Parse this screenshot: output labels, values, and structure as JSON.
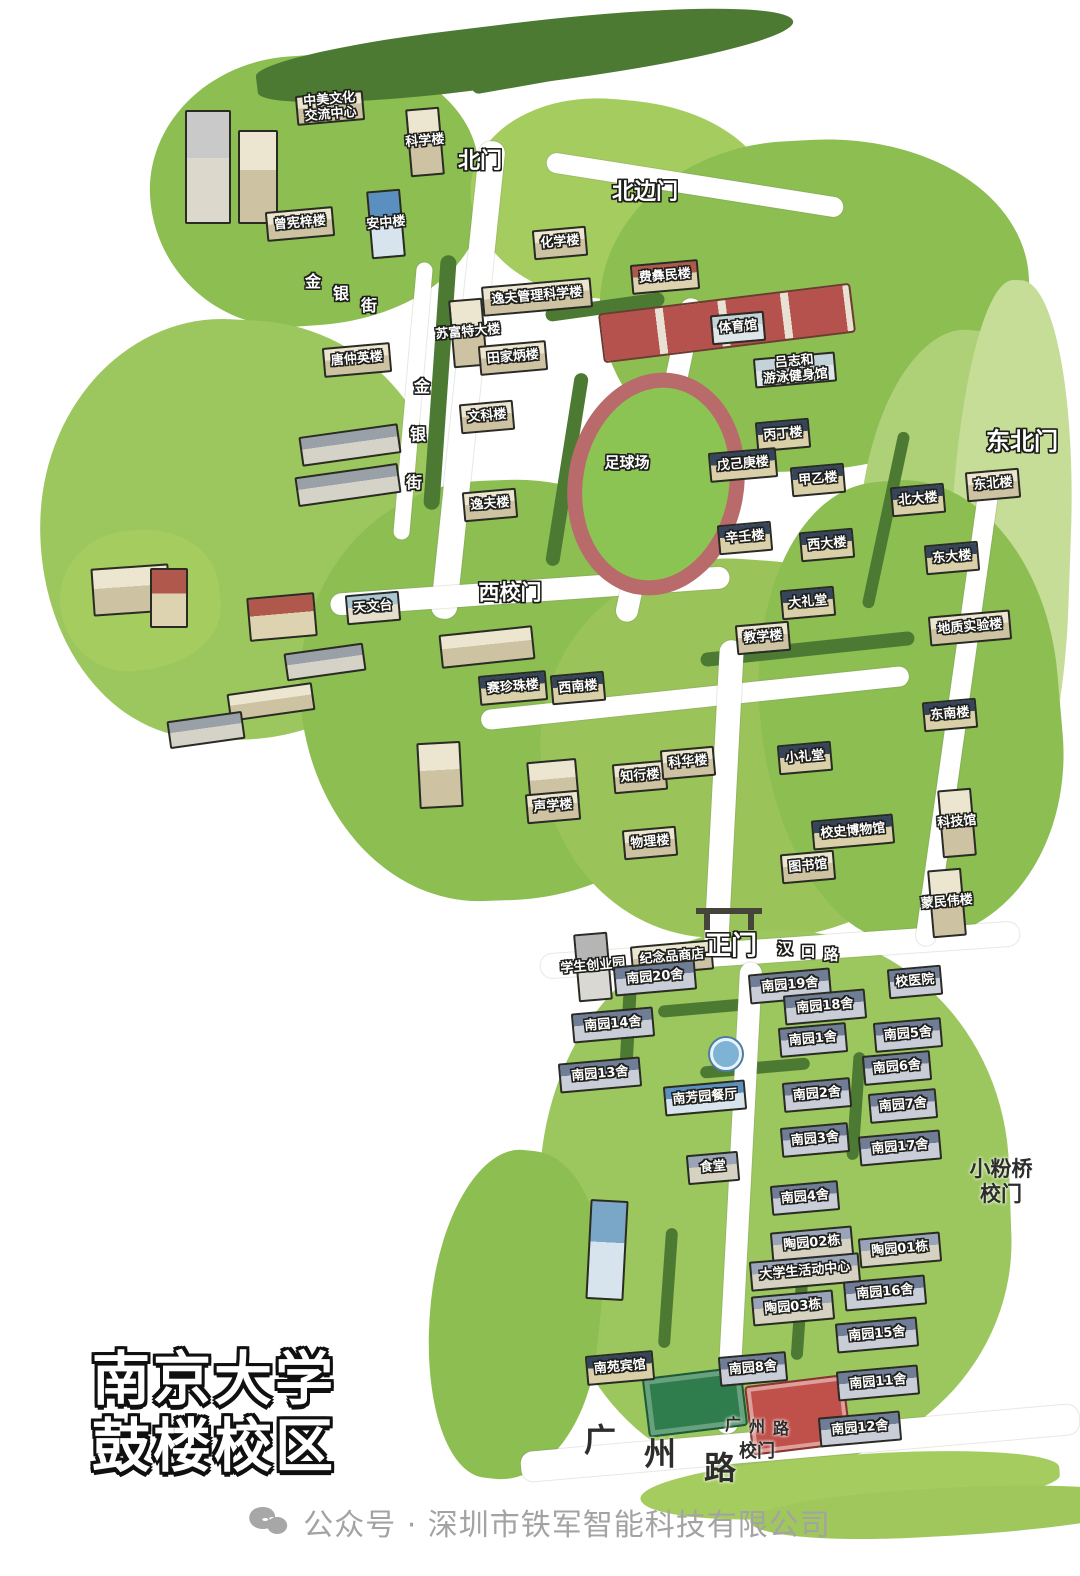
{
  "title": {
    "line1": "南京大学",
    "line2": "鼓楼校区"
  },
  "footer": {
    "icon": "wechat-icon",
    "text": "公众号 · 深圳市铁军智能科技有限公司"
  },
  "palette": {
    "roofs": {
      "trad": [
        "#35465c",
        "#d9cfa8"
      ],
      "tan": [
        "#ece5d0",
        "#cdc3a2"
      ],
      "dorm": [
        "#6f7d96",
        "#c9cdd8"
      ],
      "red": [
        "#b0584c",
        "#ddd3b0"
      ],
      "blue": [
        "#5b8fc0",
        "#d7e4ee"
      ],
      "sport": [
        "#c3d3d9",
        "#dde6e8"
      ],
      "tao": [
        "#9aa4b8",
        "#d6d2c2"
      ],
      "obs": [
        "#a9c6d4",
        "#e4decb"
      ],
      "gray": [
        "#b5b5b5",
        "#dad8d2"
      ]
    },
    "green_light": "#a5cc5f",
    "green_mid": "#8cbe52",
    "green_dark": "#4d7a33",
    "track": "#b96a6a",
    "field": "#8cc454"
  },
  "map": {
    "green_areas": [
      {
        "x": 150,
        "y": 55,
        "w": 330,
        "h": 270,
        "c": "#8cbe52",
        "rot": -4
      },
      {
        "x": 255,
        "y": 22,
        "w": 540,
        "h": 62,
        "c": "#4d7a33",
        "rot": -7,
        "r": "40% 60% 55% 45%"
      },
      {
        "x": 470,
        "y": 100,
        "w": 300,
        "h": 200,
        "c": "#a5cc5f",
        "rot": 5
      },
      {
        "x": 600,
        "y": 140,
        "w": 430,
        "h": 330,
        "c": "#8cbe52",
        "rot": -3
      },
      {
        "x": 860,
        "y": 330,
        "w": 200,
        "h": 380,
        "c": "#aed178",
        "rot": 6
      },
      {
        "x": 950,
        "y": 280,
        "w": 120,
        "h": 560,
        "c": "#c6dd97",
        "rot": 2
      },
      {
        "x": 40,
        "y": 320,
        "w": 400,
        "h": 420,
        "c": "#9cc75e",
        "rot": 3
      },
      {
        "x": 300,
        "y": 480,
        "w": 420,
        "h": 420,
        "c": "#8cbe52",
        "rot": -2
      },
      {
        "x": 540,
        "y": 560,
        "w": 420,
        "h": 380,
        "c": "#9ac359",
        "rot": 4
      },
      {
        "x": 760,
        "y": 480,
        "w": 300,
        "h": 460,
        "c": "#8cbe52",
        "rot": -5
      },
      {
        "x": 540,
        "y": 930,
        "w": 470,
        "h": 540,
        "c": "#9cc75e",
        "rot": -2
      },
      {
        "x": 430,
        "y": 1150,
        "w": 170,
        "h": 330,
        "c": "#8cbe52",
        "rot": 6
      },
      {
        "x": 640,
        "y": 1455,
        "w": 420,
        "h": 60,
        "c": "#a5cc5f",
        "rot": -4
      },
      {
        "x": 60,
        "y": 530,
        "w": 160,
        "h": 140,
        "c": "#a5cc5f",
        "rot": -6
      },
      {
        "x": 750,
        "y": 1488,
        "w": 390,
        "h": 48,
        "c": "#9fc75c",
        "rot": -3
      }
    ],
    "hedges": [
      {
        "x": 432,
        "y": 255,
        "w": 16,
        "h": 255,
        "rot": 4
      },
      {
        "x": 545,
        "y": 300,
        "w": 120,
        "h": 14,
        "rot": -8
      },
      {
        "x": 560,
        "y": 372,
        "w": 14,
        "h": 195,
        "rot": 9
      },
      {
        "x": 700,
        "y": 642,
        "w": 215,
        "h": 14,
        "rot": -6
      },
      {
        "x": 622,
        "y": 975,
        "w": 13,
        "h": 90,
        "rot": 3
      },
      {
        "x": 658,
        "y": 1002,
        "w": 90,
        "h": 12,
        "rot": -5
      },
      {
        "x": 700,
        "y": 1062,
        "w": 110,
        "h": 12,
        "rot": -5
      },
      {
        "x": 662,
        "y": 1228,
        "w": 12,
        "h": 120,
        "rot": 4
      },
      {
        "x": 795,
        "y": 1232,
        "w": 12,
        "h": 128,
        "rot": 4
      },
      {
        "x": 850,
        "y": 1052,
        "w": 12,
        "h": 108,
        "rot": 4
      },
      {
        "x": 470,
        "y": 60,
        "w": 240,
        "h": 14,
        "rot": -10
      },
      {
        "x": 880,
        "y": 430,
        "w": 12,
        "h": 180,
        "rot": 12
      }
    ],
    "roads": [
      {
        "x": 455,
        "y": 140,
        "w": 26,
        "h": 480,
        "rot": 6
      },
      {
        "x": 405,
        "y": 262,
        "w": 16,
        "h": 278,
        "rot": 5
      },
      {
        "x": 330,
        "y": 580,
        "w": 400,
        "h": 22,
        "rot": -4
      },
      {
        "x": 545,
        "y": 175,
        "w": 300,
        "h": 20,
        "rot": 9
      },
      {
        "x": 648,
        "y": 295,
        "w": 22,
        "h": 330,
        "rot": 12
      },
      {
        "x": 480,
        "y": 688,
        "w": 430,
        "h": 20,
        "rot": -6
      },
      {
        "x": 712,
        "y": 640,
        "w": 24,
        "h": 312,
        "rot": 3
      },
      {
        "x": 540,
        "y": 938,
        "w": 480,
        "h": 24,
        "rot": -4
      },
      {
        "x": 948,
        "y": 468,
        "w": 20,
        "h": 480,
        "rot": 8
      },
      {
        "x": 728,
        "y": 962,
        "w": 22,
        "h": 472,
        "rot": 3
      },
      {
        "x": 520,
        "y": 1428,
        "w": 560,
        "h": 30,
        "rot": -5
      }
    ],
    "stadium": {
      "x": 568,
      "y": 372,
      "w": 146,
      "h": 194,
      "rot": 10
    },
    "area_labels": [
      {
        "label": "足球场",
        "x": 627,
        "y": 462,
        "s": 15
      }
    ],
    "courts": [
      {
        "x": 600,
        "y": 298,
        "w": 250,
        "h": 46,
        "rot": -7,
        "kind": "red-courts"
      },
      {
        "x": 645,
        "y": 1372,
        "w": 96,
        "h": 56,
        "rot": -7,
        "kind": "green-court"
      },
      {
        "x": 748,
        "y": 1380,
        "w": 96,
        "h": 66,
        "rot": -7,
        "kind": "red-court"
      }
    ],
    "fountain": {
      "x": 710,
      "y": 1038
    },
    "gate_icon": {
      "x": 696,
      "y": 908
    },
    "gates": [
      {
        "label": "北门",
        "x": 480,
        "y": 162,
        "s": 22
      },
      {
        "label": "北边门",
        "x": 645,
        "y": 193,
        "s": 22
      },
      {
        "label": "东北门",
        "x": 1022,
        "y": 442,
        "s": 24
      },
      {
        "label": "西校门",
        "x": 510,
        "y": 593,
        "s": 21
      },
      {
        "label": "正门",
        "x": 731,
        "y": 947,
        "s": 26
      },
      {
        "label": "小粉桥",
        "label2": "校门",
        "x": 1001,
        "y": 1182,
        "s": 21,
        "dark": true
      },
      {
        "label": "校门",
        "x": 757,
        "y": 1452,
        "s": 18,
        "dark": true
      }
    ],
    "streets": [
      {
        "label": "金银街",
        "x": 313,
        "y": 280,
        "dx": 28,
        "dy": 12,
        "s": 16
      },
      {
        "label": "金银街",
        "x": 422,
        "y": 385,
        "dx": -4,
        "dy": 48,
        "s": 16
      },
      {
        "label": "汉口路",
        "x": 785,
        "y": 948,
        "dx": 23,
        "dy": 3,
        "s": 15
      },
      {
        "label": "广州路",
        "x": 600,
        "y": 1438,
        "dx": 60,
        "dy": 14,
        "s": 32,
        "dark": true
      },
      {
        "label": "广州路",
        "x": 733,
        "y": 1423,
        "dx": 24,
        "dy": 2,
        "s": 16,
        "dark": true
      }
    ],
    "buildings": [
      {
        "label": "中美文化",
        "label2": "交流中心",
        "x": 330,
        "y": 108,
        "t": "tan"
      },
      {
        "label": "科学楼",
        "x": 425,
        "y": 142,
        "t": "tan",
        "tall": true
      },
      {
        "label": "曾宪梓楼",
        "x": 300,
        "y": 224,
        "t": "tan"
      },
      {
        "label": "安中楼",
        "x": 386,
        "y": 224,
        "t": "blue",
        "tall": true
      },
      {
        "label": "化学楼",
        "x": 560,
        "y": 243,
        "t": "tan"
      },
      {
        "label": "逸夫管理科学楼",
        "x": 537,
        "y": 297,
        "t": "tan"
      },
      {
        "label": "苏富特大楼",
        "x": 468,
        "y": 333,
        "t": "tan",
        "tall": true
      },
      {
        "label": "田家炳楼",
        "x": 513,
        "y": 358,
        "t": "tan"
      },
      {
        "label": "费彝民楼",
        "x": 665,
        "y": 277,
        "t": "red"
      },
      {
        "label": "体育馆",
        "x": 738,
        "y": 328,
        "t": "sport"
      },
      {
        "label": "吕志和",
        "label2": "游泳健身馆",
        "x": 795,
        "y": 370,
        "t": "sport"
      },
      {
        "label": "唐仲英楼",
        "x": 357,
        "y": 360,
        "t": "tan"
      },
      {
        "label": "文科楼",
        "x": 487,
        "y": 417,
        "t": "tan"
      },
      {
        "label": "逸夫楼",
        "x": 490,
        "y": 505,
        "t": "tan"
      },
      {
        "label": "丙丁楼",
        "x": 783,
        "y": 435,
        "t": "trad"
      },
      {
        "label": "戊己庚楼",
        "x": 743,
        "y": 465,
        "t": "trad"
      },
      {
        "label": "甲乙楼",
        "x": 818,
        "y": 480,
        "t": "trad"
      },
      {
        "label": "辛壬楼",
        "x": 745,
        "y": 538,
        "t": "trad"
      },
      {
        "label": "西大楼",
        "x": 827,
        "y": 545,
        "t": "trad"
      },
      {
        "label": "北大楼",
        "x": 918,
        "y": 500,
        "t": "trad"
      },
      {
        "label": "东大楼",
        "x": 952,
        "y": 558,
        "t": "trad"
      },
      {
        "label": "东北楼",
        "x": 993,
        "y": 485,
        "t": "tan"
      },
      {
        "label": "大礼堂",
        "x": 808,
        "y": 603,
        "t": "trad"
      },
      {
        "label": "教学楼",
        "x": 763,
        "y": 638,
        "t": "tan"
      },
      {
        "label": "天文台",
        "x": 373,
        "y": 608,
        "t": "obs"
      },
      {
        "label": "赛珍珠楼",
        "x": 513,
        "y": 688,
        "t": "trad"
      },
      {
        "label": "西南楼",
        "x": 578,
        "y": 688,
        "t": "trad"
      },
      {
        "label": "地质实验楼",
        "x": 970,
        "y": 628,
        "t": "tan"
      },
      {
        "label": "东南楼",
        "x": 950,
        "y": 715,
        "t": "trad"
      },
      {
        "label": "知行楼",
        "x": 640,
        "y": 777,
        "t": "tan"
      },
      {
        "label": "科华楼",
        "x": 688,
        "y": 763,
        "t": "tan"
      },
      {
        "label": "小礼堂",
        "x": 805,
        "y": 758,
        "t": "trad"
      },
      {
        "label": "声学楼",
        "x": 553,
        "y": 807,
        "t": "tan"
      },
      {
        "label": "物理楼",
        "x": 650,
        "y": 843,
        "t": "tan"
      },
      {
        "label": "校史博物馆",
        "x": 853,
        "y": 832,
        "t": "trad"
      },
      {
        "label": "图书馆",
        "x": 808,
        "y": 867,
        "t": "tan"
      },
      {
        "label": "科技馆",
        "x": 957,
        "y": 823,
        "t": "tan",
        "tall": true
      },
      {
        "label": "蒙民伟楼",
        "x": 947,
        "y": 903,
        "t": "tan",
        "tall": true
      },
      {
        "label": "学生创业园",
        "x": 593,
        "y": 967,
        "t": "gray",
        "tall": true
      },
      {
        "label": "纪念品商店",
        "x": 672,
        "y": 958,
        "t": "tan"
      },
      {
        "label": "南园20舍",
        "x": 655,
        "y": 978,
        "t": "dorm"
      },
      {
        "label": "南园19舍",
        "x": 790,
        "y": 986,
        "t": "dorm"
      },
      {
        "label": "校医院",
        "x": 915,
        "y": 982,
        "t": "dorm"
      },
      {
        "label": "南园18舍",
        "x": 825,
        "y": 1007,
        "t": "dorm"
      },
      {
        "label": "南园14舍",
        "x": 613,
        "y": 1025,
        "t": "dorm"
      },
      {
        "label": "南园1舍",
        "x": 813,
        "y": 1040,
        "t": "dorm"
      },
      {
        "label": "南园5舍",
        "x": 908,
        "y": 1035,
        "t": "dorm"
      },
      {
        "label": "南园6舍",
        "x": 897,
        "y": 1068,
        "t": "dorm"
      },
      {
        "label": "南园13舍",
        "x": 600,
        "y": 1075,
        "t": "dorm"
      },
      {
        "label": "南园2舍",
        "x": 817,
        "y": 1095,
        "t": "dorm"
      },
      {
        "label": "南园7舍",
        "x": 903,
        "y": 1106,
        "t": "dorm"
      },
      {
        "label": "南芳园餐厅",
        "x": 705,
        "y": 1098,
        "t": "blue"
      },
      {
        "label": "南园3舍",
        "x": 815,
        "y": 1140,
        "t": "dorm"
      },
      {
        "label": "南园17舍",
        "x": 900,
        "y": 1148,
        "t": "dorm"
      },
      {
        "label": "食堂",
        "x": 713,
        "y": 1168,
        "t": "tao"
      },
      {
        "label": "南园4舍",
        "x": 805,
        "y": 1198,
        "t": "dorm"
      },
      {
        "label": "陶园02栋",
        "x": 812,
        "y": 1244,
        "t": "tao"
      },
      {
        "label": "陶园01栋",
        "x": 900,
        "y": 1250,
        "t": "tao"
      },
      {
        "label": "大学生活动中心",
        "x": 805,
        "y": 1272,
        "t": "tao"
      },
      {
        "label": "南园16舍",
        "x": 885,
        "y": 1293,
        "t": "dorm"
      },
      {
        "label": "陶园03栋",
        "x": 793,
        "y": 1308,
        "t": "tao"
      },
      {
        "label": "南园15舍",
        "x": 877,
        "y": 1335,
        "t": "dorm"
      },
      {
        "label": "南苑宾馆",
        "x": 620,
        "y": 1368,
        "t": "trad"
      },
      {
        "label": "南园8舍",
        "x": 753,
        "y": 1369,
        "t": "dorm"
      },
      {
        "label": "南园11舍",
        "x": 878,
        "y": 1383,
        "t": "dorm"
      },
      {
        "label": "南园12舍",
        "x": 860,
        "y": 1429,
        "t": "dorm"
      }
    ],
    "blocks": [
      {
        "x": 185,
        "y": 110,
        "w": 42,
        "h": 110,
        "rot": 0,
        "c1": "#c9c9c9",
        "c2": "#dcd8cc"
      },
      {
        "x": 238,
        "y": 130,
        "w": 36,
        "h": 90,
        "rot": 0,
        "c1": "#ece5d0",
        "c2": "#cdc3a2"
      },
      {
        "x": 300,
        "y": 430,
        "w": 96,
        "h": 26,
        "rot": -8,
        "c1": "#9aa0a8",
        "c2": "#d5d2c8"
      },
      {
        "x": 296,
        "y": 470,
        "w": 100,
        "h": 26,
        "rot": -8,
        "c1": "#9aa0a8",
        "c2": "#d5d2c8"
      },
      {
        "x": 248,
        "y": 595,
        "w": 64,
        "h": 40,
        "rot": -5,
        "c1": "#b0584c",
        "c2": "#ddd3b0"
      },
      {
        "x": 285,
        "y": 648,
        "w": 76,
        "h": 24,
        "rot": -8,
        "c1": "#9aa0a8",
        "c2": "#d5d2c8"
      },
      {
        "x": 228,
        "y": 688,
        "w": 82,
        "h": 24,
        "rot": -8,
        "c1": "#ece5d0",
        "c2": "#cdc3a2"
      },
      {
        "x": 168,
        "y": 716,
        "w": 72,
        "h": 24,
        "rot": -8,
        "c1": "#9aa0a8",
        "c2": "#d5d2c8"
      },
      {
        "x": 92,
        "y": 566,
        "w": 74,
        "h": 44,
        "rot": -4,
        "c1": "#ece5d0",
        "c2": "#cdc3a2"
      },
      {
        "x": 150,
        "y": 568,
        "w": 34,
        "h": 56,
        "rot": 0,
        "c1": "#b0584c",
        "c2": "#ddd3b0"
      },
      {
        "x": 418,
        "y": 742,
        "w": 40,
        "h": 62,
        "rot": -3,
        "c1": "#ece5d0",
        "c2": "#cdc3a2"
      },
      {
        "x": 528,
        "y": 760,
        "w": 46,
        "h": 40,
        "rot": -5,
        "c1": "#ece5d0",
        "c2": "#cdc3a2"
      },
      {
        "x": 588,
        "y": 1200,
        "w": 34,
        "h": 96,
        "rot": 3,
        "c1": "#7aa7c7",
        "c2": "#d7e4ee"
      },
      {
        "x": 440,
        "y": 630,
        "w": 90,
        "h": 30,
        "rot": -6,
        "c1": "#ece5d0",
        "c2": "#cdc3a2"
      }
    ]
  }
}
